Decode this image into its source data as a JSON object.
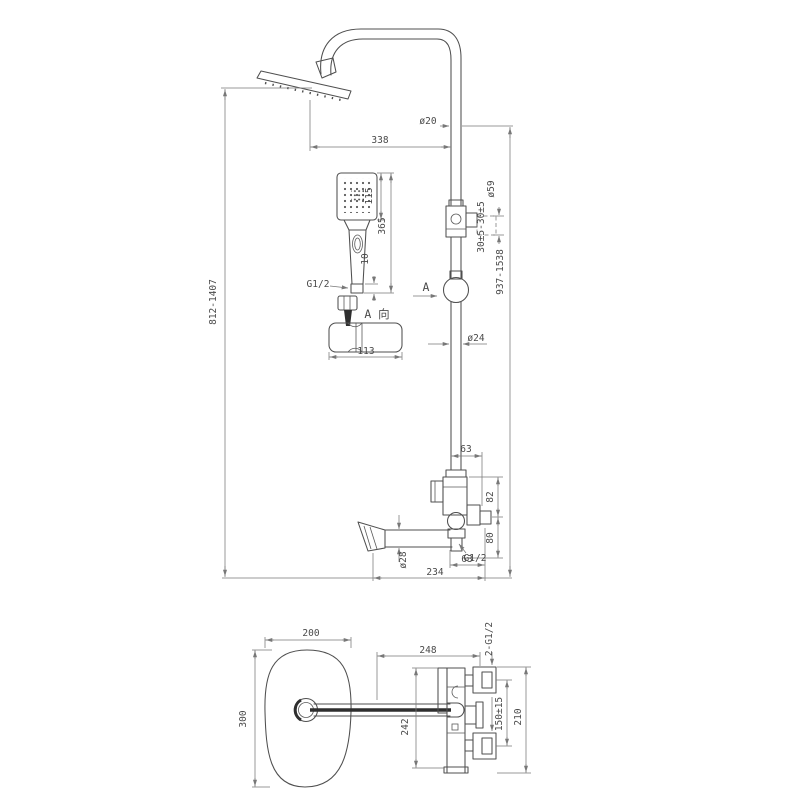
{
  "front": {
    "pipe_dia": "ø20",
    "arm_reach": "338",
    "height_left": "812-1407",
    "height_right": "937-1538",
    "hs_width": "115",
    "hs_length": "365",
    "hs_conn": "10",
    "hs_thread": "G1/2",
    "view_a": "A 向",
    "bracket_len": "113",
    "section_a": "A",
    "slider_range": "30±5-30±5",
    "slider_dia": "ø59",
    "rail_dia": "ø24",
    "offset_top": "63",
    "space_upper": "82",
    "space_lower": "80",
    "outlet_thread": "G1/2",
    "spout_dia": "ø28",
    "offset_bottom": "63",
    "spout_reach": "234"
  },
  "top": {
    "head_w": "200",
    "head_d": "300",
    "reach": "248",
    "body_d": "242",
    "inlets": "2-G1/2",
    "inlet_space": "150±15",
    "body_w": "210"
  },
  "colors": {
    "line": "#4f4f4f",
    "dim": "#787878",
    "bg": "#ffffff"
  }
}
